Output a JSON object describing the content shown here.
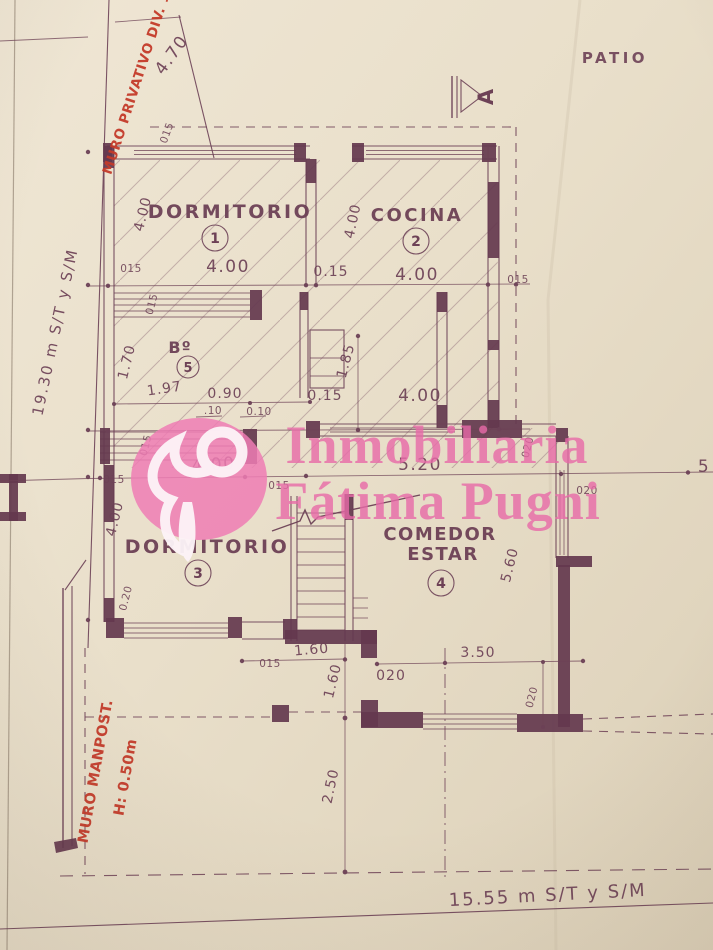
{
  "colors": {
    "paper": "#e9dfca",
    "ink": "#6d4156",
    "ink-text": "#6d4156",
    "wall": "#64384e",
    "red": "#c43b2a",
    "pink": "#ee7db4",
    "pink-text": "#e86aa8"
  },
  "labels": {
    "patio": "PATIO",
    "section_marker": "A"
  },
  "annotations_red": {
    "top_boundary": "MURO PRIVATIVO DIV. 18",
    "wall_line1": "MURO MANPOST.",
    "wall_line2": "H: 0.50m"
  },
  "rooms": {
    "dormitorio1": {
      "name": "DORMITORIO",
      "number": "1"
    },
    "cocina": {
      "name": "COCINA",
      "number": "2"
    },
    "dormitorio3": {
      "name": "DORMITORIO",
      "number": "3"
    },
    "comedor": {
      "name_line1": "COMEDOR",
      "name_line2": "ESTAR",
      "number": "4"
    },
    "bano": {
      "name": "Bº",
      "number": "5"
    }
  },
  "totals": {
    "left": "19.30 m S/T y S/M",
    "bottom": "15.55 m S/T y S/M"
  },
  "watermark": {
    "line1": "Inmobiliaria",
    "line2": "Fátima Pugni"
  },
  "dims": {
    "d470": "4.70",
    "d015_top": "015",
    "v400_d1": "4.00",
    "h015_l": "015",
    "h400_d1": "4.00",
    "h015_m": "0.15",
    "v400_c": "4.00",
    "h400_c": "4.00",
    "h015_r": "015",
    "v015_b": "015",
    "v170": "1.70",
    "d197": "1.97",
    "d090": "0.90",
    "d010a": ".10",
    "d010b": "0.10",
    "v185": "1.85",
    "h015_hall": "0.15",
    "h400_hall": "4.00",
    "v015_w": "015",
    "h400_d3": "4.00",
    "h015_w": "015",
    "h015_s": "015",
    "h520": "5.20",
    "v020_r": "020",
    "h020_r": "020",
    "d5": "5",
    "v400_d3": "4.00",
    "v020_d3": "0.20",
    "v560": "5.60",
    "h160": "1.60",
    "h350": "3.50",
    "v160": "1.60",
    "h020_b": "020",
    "v020_b": "020",
    "h015_b": "015",
    "v250": "2.50"
  }
}
